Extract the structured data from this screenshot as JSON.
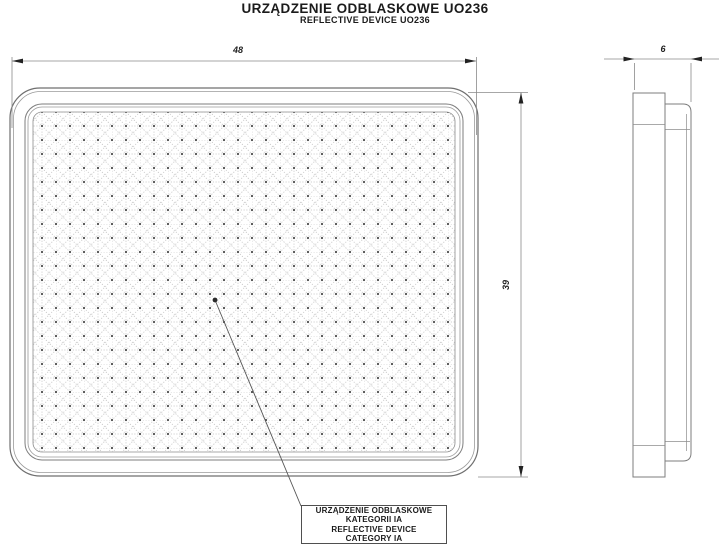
{
  "title": {
    "line1": "URZĄDZENIE ODBLASKOWE UO236",
    "line2": "REFLECTIVE DEVICE UO236"
  },
  "dimensions": {
    "width": "48",
    "height": "39",
    "thickness": "6"
  },
  "callout": {
    "line1": "URZĄDZENIE ODBLASKOWE",
    "line2": "KATEGORII IA",
    "line3": "REFLECTIVE DEVICE",
    "line4": "CATEGORY IA"
  },
  "colors": {
    "background": "#ffffff",
    "outline": "#6f6f6f",
    "light_line": "#9a9a9a",
    "dimension_line": "#8a8a8a",
    "arrow": "#222222",
    "pattern_line": "#b3b3b3",
    "pattern_dot": "#4d4d4d",
    "text": "#1b1b1b"
  },
  "views": {
    "front_view": "front view of reflector with prismatic pattern",
    "side_view": "side profile view of reflector"
  }
}
